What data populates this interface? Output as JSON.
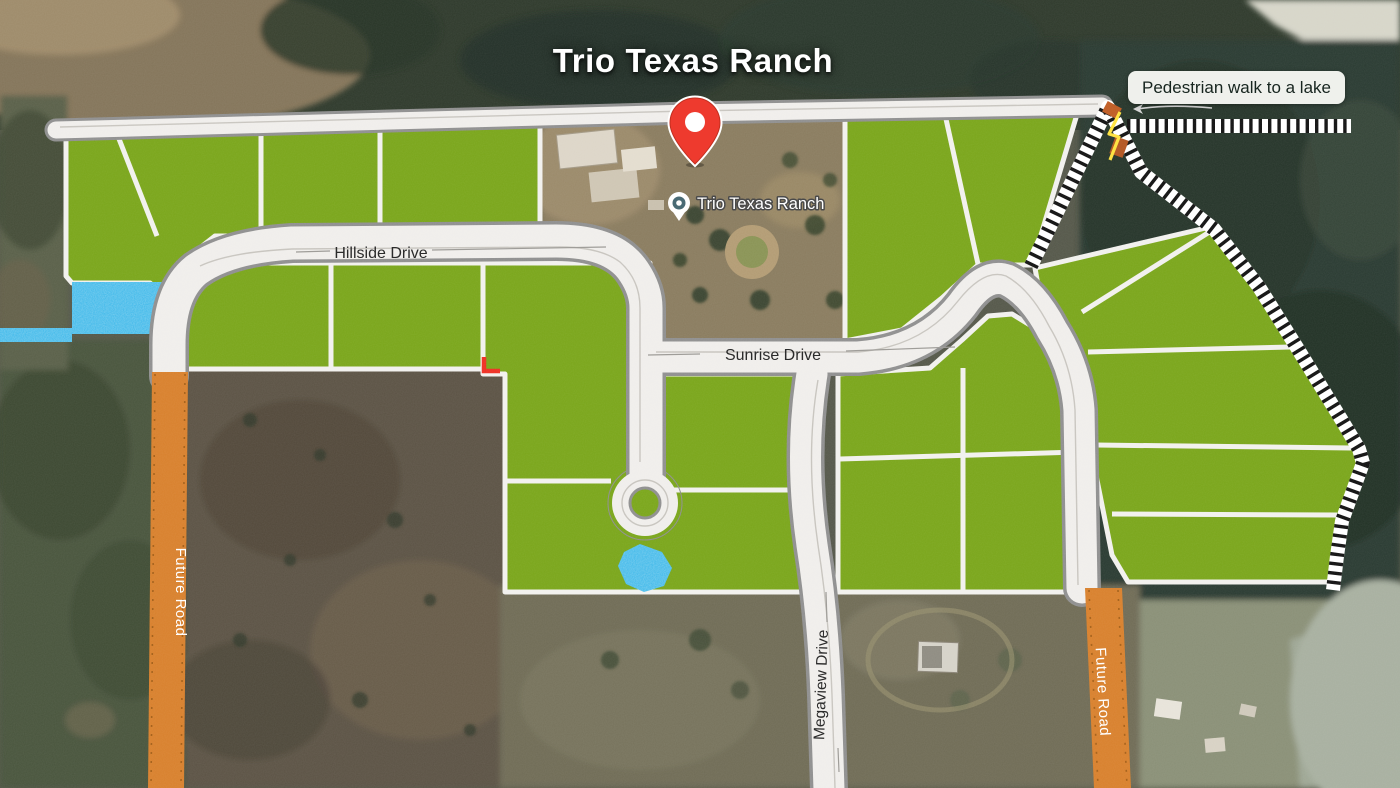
{
  "title": "Trio Texas Ranch",
  "poi": {
    "label": "Trio Texas Ranch"
  },
  "callout": {
    "text": "Pedestrian walk to a lake"
  },
  "roads": {
    "hillside": "Hillside Drive",
    "sunrise": "Sunrise Drive",
    "megaview": "Megaview Drive",
    "future_left": "Future Road",
    "future_right": "Future Road"
  },
  "colors": {
    "lot_green": "#7aa61a",
    "road_fill": "#f0eeeb",
    "road_casing": "#8f8f8f",
    "future_road_orange": "#d8802c",
    "water_blue": "#38b6e9",
    "pin_red": "#ee3a2e",
    "hatch_black": "#111111"
  }
}
